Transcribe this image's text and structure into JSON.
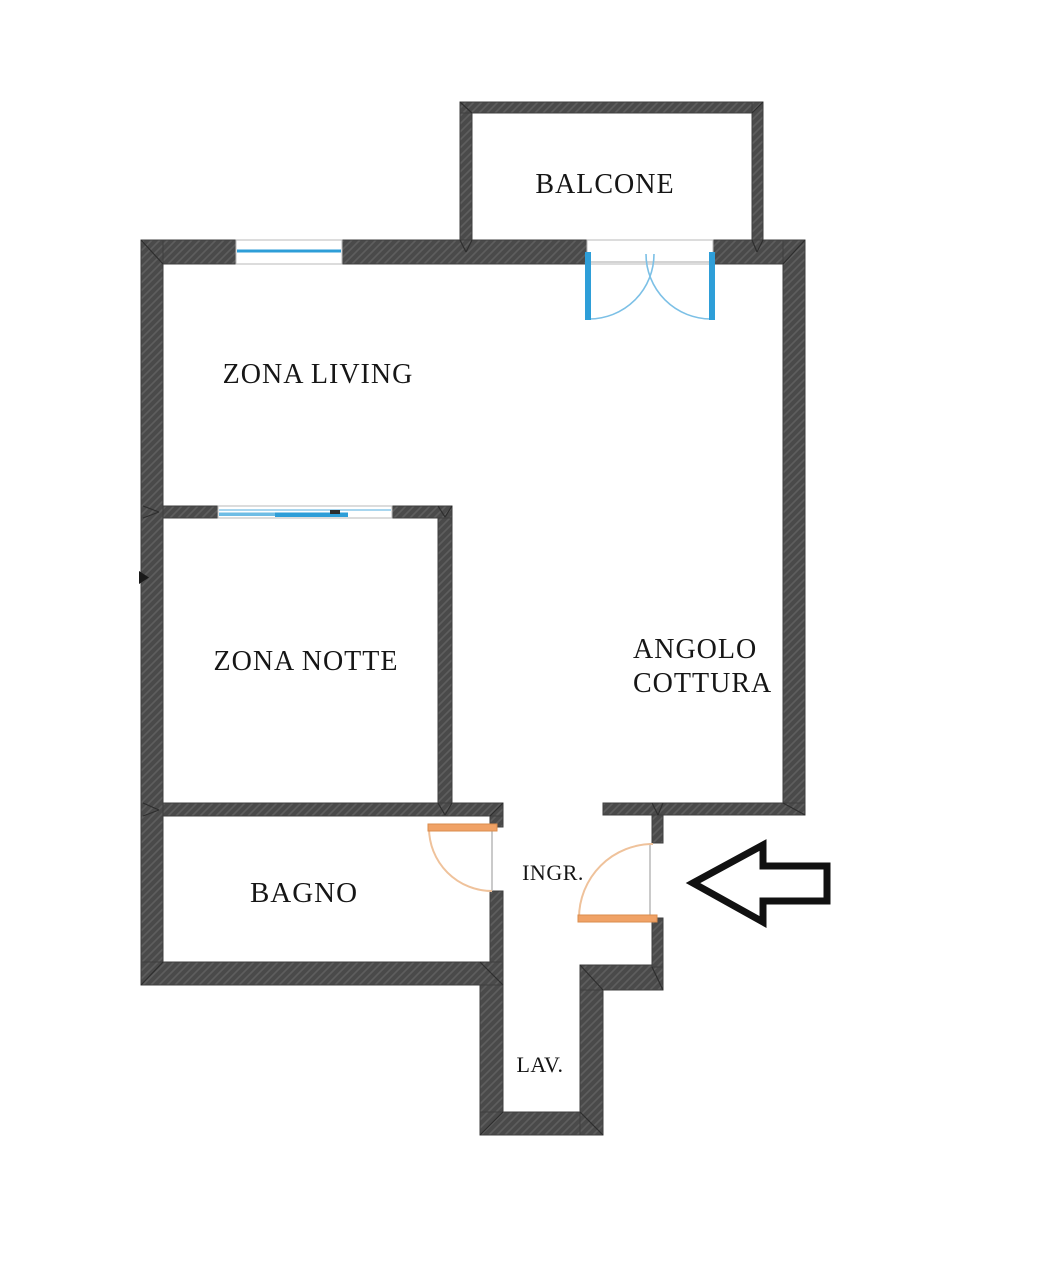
{
  "plan": {
    "canvas": {
      "width": 1043,
      "height": 1280,
      "background": "#ffffff"
    },
    "style": {
      "wall_fill": "#4a4a4a",
      "wall_hatch": "#5e5e5e",
      "wall_stroke": "#3f3f3f",
      "seam_color": "#2e2e2e",
      "frame_color": "#b9b9b9",
      "door_leaf_fill": "#f0a266",
      "door_leaf_border": "#da8c4e",
      "door_arc_color": "#efc29b",
      "glass_blue": "#2e9ed8",
      "glass_mid_blue": "#6fbde5",
      "glass_light_blue": "#a8d6ef",
      "handle_color": "#2d2d2d",
      "text_color": "#161616",
      "arrow_stroke": "#111111",
      "arrow_fill": "#ffffff",
      "marker_color": "#1a1a1a"
    },
    "walls": [
      {
        "name": "main-top-wall-left-segment",
        "x": 141,
        "y": 240,
        "w": 95,
        "h": 24
      },
      {
        "name": "main-top-wall-middle-segment",
        "x": 342,
        "y": 240,
        "w": 245,
        "h": 24
      },
      {
        "name": "main-top-wall-right-segment",
        "x": 713,
        "y": 240,
        "w": 92,
        "h": 24
      },
      {
        "name": "main-left-wall",
        "x": 141,
        "y": 240,
        "w": 22,
        "h": 745
      },
      {
        "name": "main-right-wall",
        "x": 783,
        "y": 240,
        "w": 22,
        "h": 575
      },
      {
        "name": "living-notte-wall-left",
        "x": 163,
        "y": 506,
        "w": 55,
        "h": 12
      },
      {
        "name": "living-notte-wall-right",
        "x": 392,
        "y": 506,
        "w": 60,
        "h": 12
      },
      {
        "name": "notte-right-wall",
        "x": 438,
        "y": 518,
        "w": 14,
        "h": 285
      },
      {
        "name": "bagno-top-wall",
        "x": 163,
        "y": 803,
        "w": 340,
        "h": 13
      },
      {
        "name": "bagno-right-wall-stub",
        "x": 490,
        "y": 816,
        "w": 13,
        "h": 11
      },
      {
        "name": "bagno-right-wall-lower",
        "x": 490,
        "y": 891,
        "w": 13,
        "h": 71
      },
      {
        "name": "bagno-bottom-wall",
        "x": 141,
        "y": 962,
        "w": 362,
        "h": 23
      },
      {
        "name": "lav-left-wall",
        "x": 480,
        "y": 985,
        "w": 23,
        "h": 150
      },
      {
        "name": "lav-bottom-wall",
        "x": 480,
        "y": 1112,
        "w": 123,
        "h": 23
      },
      {
        "name": "lav-right-wall",
        "x": 580,
        "y": 990,
        "w": 23,
        "h": 145
      },
      {
        "name": "ingresso-step-wall",
        "x": 580,
        "y": 965,
        "w": 83,
        "h": 25
      },
      {
        "name": "entrance-wall-stub",
        "x": 652,
        "y": 815,
        "w": 11,
        "h": 28
      },
      {
        "name": "entrance-wall-lower",
        "x": 652,
        "y": 918,
        "w": 11,
        "h": 49
      },
      {
        "name": "kitchen-bottom-wall",
        "x": 603,
        "y": 803,
        "w": 202,
        "h": 12
      },
      {
        "name": "balcony-left-wall",
        "x": 460,
        "y": 102,
        "w": 12,
        "h": 138
      },
      {
        "name": "balcony-top-wall",
        "x": 460,
        "y": 102,
        "w": 303,
        "h": 11
      },
      {
        "name": "balcony-right-wall",
        "x": 752,
        "y": 102,
        "w": 11,
        "h": 138
      }
    ],
    "seams": [
      [
        141,
        240,
        163,
        264
      ],
      [
        805,
        240,
        783,
        264
      ],
      [
        460,
        102,
        472,
        113
      ],
      [
        763,
        102,
        752,
        113
      ],
      [
        460,
        240,
        466,
        252
      ],
      [
        472,
        240,
        466,
        252
      ],
      [
        752,
        240,
        757,
        252
      ],
      [
        763,
        240,
        757,
        252
      ],
      [
        143,
        506,
        159,
        512
      ],
      [
        143,
        518,
        159,
        512
      ],
      [
        438,
        506,
        445,
        517
      ],
      [
        452,
        506,
        445,
        517
      ],
      [
        438,
        803,
        445,
        815
      ],
      [
        452,
        803,
        445,
        815
      ],
      [
        143,
        803,
        159,
        810
      ],
      [
        143,
        816,
        159,
        810
      ],
      [
        652,
        803,
        658,
        815
      ],
      [
        663,
        803,
        658,
        815
      ],
      [
        783,
        803,
        805,
        815
      ],
      [
        141,
        985,
        163,
        962
      ],
      [
        480,
        962,
        503,
        985
      ],
      [
        480,
        1135,
        503,
        1112
      ],
      [
        603,
        1135,
        580,
        1112
      ],
      [
        580,
        965,
        603,
        990
      ],
      [
        663,
        990,
        652,
        967
      ],
      [
        503,
        803,
        490,
        816
      ]
    ],
    "openings": [
      {
        "name": "living-top-window-opening",
        "x": 236,
        "y": 240,
        "w": 106,
        "h": 24
      },
      {
        "name": "balcony-door-opening",
        "x": 587,
        "y": 240,
        "w": 126,
        "h": 24
      },
      {
        "name": "living-notte-window-opening",
        "x": 218,
        "y": 506,
        "w": 174,
        "h": 12
      }
    ],
    "top_window": {
      "glass_line": {
        "x1": 237,
        "y1": 251,
        "x2": 341,
        "y2": 251,
        "width": 3
      }
    },
    "notte_window": {
      "light_line": {
        "x1": 219,
        "y1": 510,
        "x2": 391,
        "y2": 510,
        "width": 2
      },
      "mid_bar": {
        "x": 219,
        "y": 512.5,
        "w": 129,
        "h": 3.5
      },
      "blue_bar": {
        "x": 275,
        "y": 512.5,
        "w": 73,
        "h": 4.5
      },
      "handle": {
        "x": 330,
        "y": 510,
        "w": 10,
        "h": 4
      }
    },
    "balcony_door": {
      "sill_line": {
        "x1": 588,
        "y1": 262,
        "x2": 712,
        "y2": 262,
        "width": 1.2
      },
      "posts": [
        {
          "name": "balcony-door-left-leaf",
          "x": 585,
          "y": 252,
          "w": 6,
          "h": 68
        },
        {
          "name": "balcony-door-right-leaf",
          "x": 709,
          "y": 252,
          "w": 6,
          "h": 68
        }
      ],
      "arcs": [
        {
          "name": "balcony-door-left-swing-arc",
          "d": "M 589 319 A 65 65 0 0 0 654 254"
        },
        {
          "name": "balcony-door-right-swing-arc",
          "d": "M 711 319 A 65 65 0 0 1 646 254"
        }
      ],
      "arc_color": "#7cc0e6"
    },
    "doors": [
      {
        "name": "bagno-door",
        "frame": {
          "x1": 492,
          "y1": 827,
          "x2": 492,
          "y2": 891
        },
        "leaf": {
          "x": 428,
          "y": 824,
          "w": 69,
          "h": 7
        },
        "arc": "M 429 828 A 63 63 0 0 0 492 891"
      },
      {
        "name": "entrance-door",
        "frame": {
          "x1": 650,
          "y1": 843,
          "x2": 650,
          "y2": 918
        },
        "leaf": {
          "x": 578,
          "y": 915,
          "w": 79,
          "h": 7
        },
        "arc": "M 579 918 A 74 74 0 0 1 653 844"
      }
    ],
    "arrow": {
      "points": "693,883 763,845 763,866 827,866 827,901 763,901 763,922",
      "stroke_width": 7
    },
    "marker": {
      "points": "139,571 149,577.5 139,584"
    },
    "labels": [
      {
        "id": "balcone",
        "text": "BALCONE",
        "x": 605,
        "y": 193,
        "size": 28,
        "anchor": "middle",
        "spacing": 1
      },
      {
        "id": "zona-living",
        "text": "ZONA LIVING",
        "x": 318,
        "y": 383,
        "size": 28,
        "anchor": "middle",
        "spacing": 1
      },
      {
        "id": "zona-notte",
        "text": "ZONA NOTTE",
        "x": 306,
        "y": 670,
        "size": 28,
        "anchor": "middle",
        "spacing": 1
      },
      {
        "id": "angolo",
        "text": "ANGOLO",
        "x": 633,
        "y": 658,
        "size": 28,
        "anchor": "start",
        "spacing": 1
      },
      {
        "id": "cottura",
        "text": "COTTURA",
        "x": 633,
        "y": 692,
        "size": 28,
        "anchor": "start",
        "spacing": 1
      },
      {
        "id": "bagno",
        "text": "BAGNO",
        "x": 304,
        "y": 902,
        "size": 29,
        "anchor": "middle",
        "spacing": 1
      },
      {
        "id": "ingresso",
        "text": "INGR.",
        "x": 553,
        "y": 880,
        "size": 22,
        "anchor": "middle",
        "spacing": 0.5
      },
      {
        "id": "lavanderia",
        "text": "LAV.",
        "x": 540,
        "y": 1072,
        "size": 22,
        "anchor": "middle",
        "spacing": 0.5
      }
    ]
  }
}
